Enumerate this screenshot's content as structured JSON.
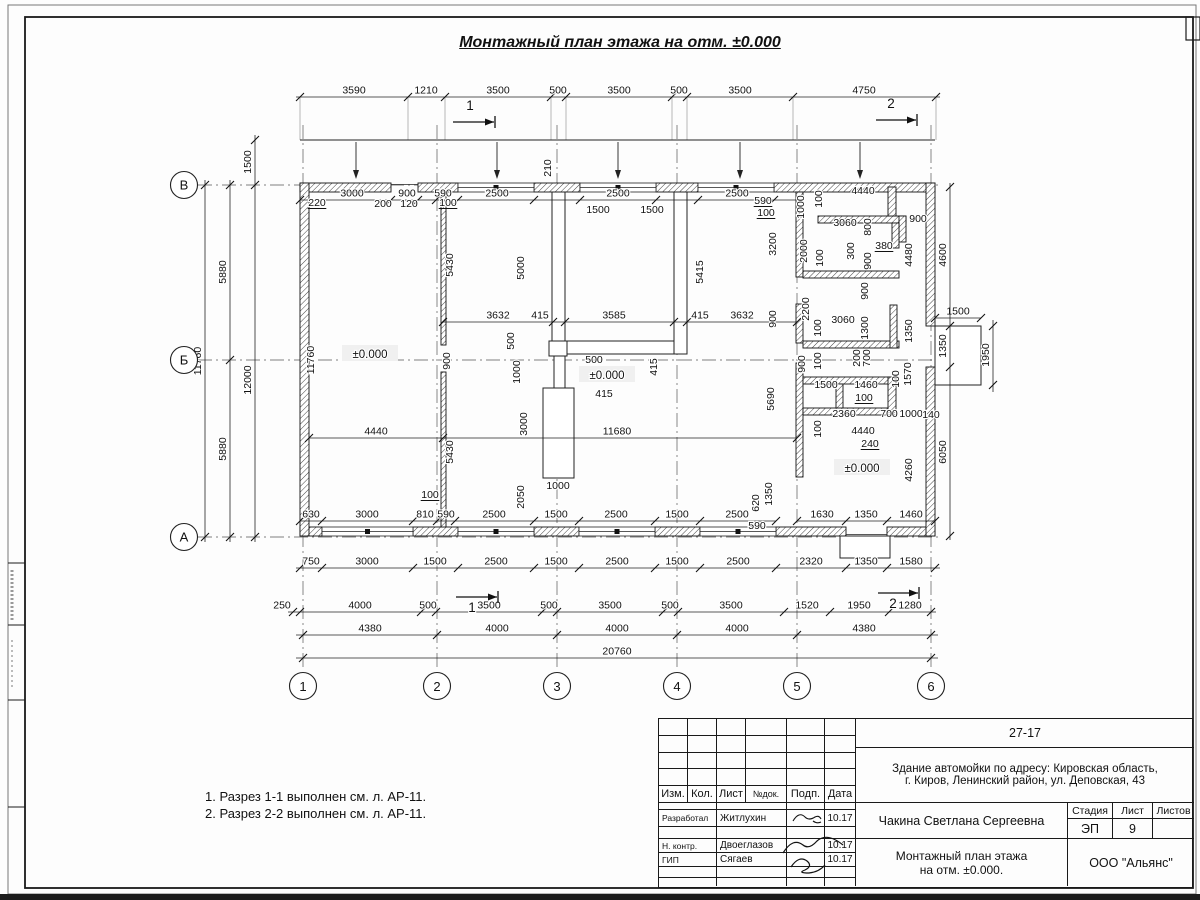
{
  "sheet_title": "Монтажный план этажа на отм. ±0.000",
  "notes": [
    "1. Разрез 1-1 выполнен см. л. АР-11.",
    "2. Разрез 2-2 выполнен см. л. АР-11."
  ],
  "title_block": {
    "doc_number": "27-17",
    "address_line1": "Здание автомойки по адресу: Кировская область,",
    "address_line2": "г. Киров, Ленинский район, ул. Деповская, 43",
    "header": {
      "izm": "Изм.",
      "kol": "Кол.",
      "list": "Лист",
      "ndok": "№док.",
      "podp": "Подп.",
      "data": "Дата"
    },
    "rows": [
      {
        "role": "Разработал",
        "name": "Житлухин",
        "date": "10.17"
      },
      {
        "role": "Н. контр.",
        "name": "Двоеглазов",
        "date": "10.17"
      },
      {
        "role": "ГИП",
        "name": "Сягаев",
        "date": "10.17"
      }
    ],
    "supervisor": "Чакина Светлана Сергеевна",
    "stage_label": "Стадия",
    "sheet_label": "Лист",
    "sheets_label": "Листов",
    "stage": "ЭП",
    "sheet_no": "9",
    "sheets_total": "",
    "drawing_name1": "Монтажный план этажа",
    "drawing_name2": "на отм. ±0.000.",
    "company": "ООО \"Альянс\""
  },
  "plan": {
    "axis_cols": [
      {
        "label": "1",
        "x": 303
      },
      {
        "label": "2",
        "x": 437
      },
      {
        "label": "3",
        "x": 557
      },
      {
        "label": "4",
        "x": 677
      },
      {
        "label": "5",
        "x": 797
      },
      {
        "label": "6",
        "x": 931
      }
    ],
    "axis_rows": [
      {
        "label": "В",
        "y": 185
      },
      {
        "label": "Б",
        "y": 360
      },
      {
        "label": "А",
        "y": 537
      }
    ],
    "levels": [
      {
        "t": "±0.000",
        "x": 370,
        "y": 355
      },
      {
        "t": "±0.000",
        "x": 607,
        "y": 376
      },
      {
        "t": "±0.000",
        "x": 862,
        "y": 469
      }
    ],
    "section_marks": [
      {
        "t": "1",
        "x": 470,
        "y": 110,
        "lx1": 453,
        "lx2": 494,
        "ly": 122
      },
      {
        "t": "2",
        "x": 891,
        "y": 108,
        "lx1": 876,
        "lx2": 916,
        "ly": 120
      },
      {
        "t": "1",
        "x": 472,
        "y": 612,
        "lx1": 456,
        "lx2": 497,
        "ly": 597
      },
      {
        "t": "2",
        "x": 893,
        "y": 608,
        "lx1": 878,
        "lx2": 918,
        "ly": 593
      }
    ],
    "dim_rows": [
      {
        "y": 97,
        "x1": 296,
        "x2": 940,
        "ext_to": 140,
        "ticks": [
          300,
          408,
          445,
          551,
          566,
          672,
          687,
          793,
          936
        ],
        "labels": [
          {
            "t": "3590",
            "x": 354
          },
          {
            "t": "1210",
            "x": 426
          },
          {
            "t": "3500",
            "x": 498
          },
          {
            "t": "500",
            "x": 558
          },
          {
            "t": "3500",
            "x": 619
          },
          {
            "t": "500",
            "x": 679
          },
          {
            "t": "3500",
            "x": 740
          },
          {
            "t": "4750",
            "x": 864
          }
        ]
      },
      {
        "y": 200,
        "x1": 300,
        "x2": 797,
        "ticks": [
          300,
          391,
          418,
          436,
          458,
          534,
          580,
          656,
          698,
          774
        ],
        "labels": [
          {
            "t": "3000",
            "x": 352
          },
          {
            "t": "900",
            "x": 407
          },
          {
            "t": "590",
            "x": 443
          },
          {
            "t": "2500",
            "x": 497
          },
          {
            "t": "2500",
            "x": 618
          },
          {
            "t": "2500",
            "x": 737
          }
        ]
      },
      {
        "y": 322,
        "x1": 443,
        "x2": 797,
        "ticks": [
          443,
          553,
          565,
          674,
          687,
          797
        ],
        "labels": [
          {
            "t": "3632",
            "x": 498
          },
          {
            "t": "415",
            "x": 540
          },
          {
            "t": "3585",
            "x": 614
          },
          {
            "t": "415",
            "x": 700
          },
          {
            "t": "3632",
            "x": 742
          }
        ]
      },
      {
        "y": 438,
        "x1": 309,
        "x2": 797,
        "ticks": [
          309,
          443,
          797
        ],
        "labels": [
          {
            "t": "4440",
            "x": 376
          },
          {
            "t": "11680",
            "x": 617
          }
        ]
      },
      {
        "y": 521,
        "x1": 300,
        "x2": 776,
        "ticks": [
          300,
          322,
          413,
          437,
          455,
          534,
          579,
          655,
          700,
          776
        ],
        "labels": [
          {
            "t": "630",
            "x": 311
          },
          {
            "t": "3000",
            "x": 367
          },
          {
            "t": "810",
            "x": 425
          },
          {
            "t": "590",
            "x": 446
          },
          {
            "t": "2500",
            "x": 494
          },
          {
            "t": "1500",
            "x": 556
          },
          {
            "t": "2500",
            "x": 616
          },
          {
            "t": "1500",
            "x": 677
          },
          {
            "t": "2500",
            "x": 737
          }
        ]
      },
      {
        "y": 521,
        "x1": 797,
        "x2": 935,
        "ticks": [
          797,
          846,
          887,
          935
        ],
        "labels": [
          {
            "t": "1630",
            "x": 822
          },
          {
            "t": "1350",
            "x": 866
          },
          {
            "t": "1460",
            "x": 911
          }
        ]
      },
      {
        "y": 568,
        "x1": 296,
        "x2": 940,
        "ticks": [
          300,
          322,
          413,
          458,
          534,
          579,
          655,
          700,
          776,
          846,
          887,
          935
        ],
        "labels": [
          {
            "t": "750",
            "x": 311
          },
          {
            "t": "3000",
            "x": 367
          },
          {
            "t": "1500",
            "x": 435
          },
          {
            "t": "2500",
            "x": 496
          },
          {
            "t": "1500",
            "x": 556
          },
          {
            "t": "2500",
            "x": 617
          },
          {
            "t": "1500",
            "x": 677
          },
          {
            "t": "2500",
            "x": 738
          },
          {
            "t": "2320",
            "x": 811
          },
          {
            "t": "1350",
            "x": 866
          },
          {
            "t": "1580",
            "x": 911
          }
        ]
      },
      {
        "y": 612,
        "x1": 288,
        "x2": 936,
        "ticks": [
          293,
          300,
          421,
          436,
          542,
          557,
          663,
          678,
          784,
          830,
          889,
          931
        ],
        "labels": [
          {
            "t": "250",
            "x": 282
          },
          {
            "t": "4000",
            "x": 360
          },
          {
            "t": "500",
            "x": 428
          },
          {
            "t": "3500",
            "x": 489
          },
          {
            "t": "500",
            "x": 549
          },
          {
            "t": "3500",
            "x": 610
          },
          {
            "t": "500",
            "x": 670
          },
          {
            "t": "3500",
            "x": 731
          },
          {
            "t": "1520",
            "x": 807
          },
          {
            "t": "1950",
            "x": 859
          },
          {
            "t": "1280",
            "x": 910
          }
        ]
      },
      {
        "y": 635,
        "x1": 296,
        "x2": 938,
        "ticks": [
          303,
          437,
          557,
          677,
          797,
          931
        ],
        "labels": [
          {
            "t": "4380",
            "x": 370
          },
          {
            "t": "4000",
            "x": 497
          },
          {
            "t": "4000",
            "x": 617
          },
          {
            "t": "4000",
            "x": 737
          },
          {
            "t": "4380",
            "x": 864
          }
        ]
      },
      {
        "y": 658,
        "x1": 296,
        "x2": 938,
        "ticks": [
          303,
          931
        ],
        "labels": [
          {
            "t": "20760",
            "x": 617
          }
        ]
      },
      {
        "y": 318,
        "x1": 935,
        "x2": 981,
        "ticks": [
          935,
          981
        ],
        "labels": [
          {
            "t": "1500",
            "x": 958
          }
        ]
      }
    ],
    "dim_cols": [
      {
        "x": 205,
        "y1": 180,
        "y2": 542,
        "ticks": [
          185,
          537
        ],
        "labels": [
          {
            "t": "11760",
            "y": 361
          }
        ]
      },
      {
        "x": 230,
        "y1": 180,
        "y2": 542,
        "ticks": [
          185,
          360,
          537
        ],
        "labels": [
          {
            "t": "5880",
            "y": 272
          },
          {
            "t": "5880",
            "y": 449
          }
        ]
      },
      {
        "x": 255,
        "y1": 135,
        "y2": 542,
        "ticks": [
          140,
          185,
          537
        ],
        "labels": [
          {
            "t": "1500",
            "y": 162
          },
          {
            "t": "12000",
            "y": 380
          }
        ]
      },
      {
        "x": 950,
        "y1": 183,
        "y2": 540,
        "ticks": [
          187,
          326,
          367,
          536
        ],
        "labels": [
          {
            "t": "4600",
            "y": 255
          },
          {
            "t": "1350",
            "y": 346
          },
          {
            "t": "6050",
            "y": 452
          }
        ]
      },
      {
        "x": 993,
        "y1": 320,
        "y2": 392,
        "ticks": [
          326,
          385
        ],
        "labels": [
          {
            "t": "1950",
            "y": 355
          }
        ]
      }
    ],
    "free_labels": [
      {
        "t": "220",
        "x": 317,
        "y": 206,
        "u": 1
      },
      {
        "t": "200",
        "x": 383,
        "y": 207
      },
      {
        "t": "120",
        "x": 409,
        "y": 207
      },
      {
        "t": "100",
        "x": 448,
        "y": 206,
        "u": 1
      },
      {
        "t": "1500",
        "x": 598,
        "y": 213
      },
      {
        "t": "1500",
        "x": 652,
        "y": 213
      },
      {
        "t": "590",
        "x": 763,
        "y": 204,
        "u": 1
      },
      {
        "t": "100",
        "x": 766,
        "y": 216,
        "u": 1
      },
      {
        "t": "210",
        "x": 551,
        "y": 168,
        "r": 1
      },
      {
        "t": "5430",
        "x": 453,
        "y": 265,
        "r": 1
      },
      {
        "t": "900",
        "x": 450,
        "y": 361,
        "r": 1
      },
      {
        "t": "5430",
        "x": 453,
        "y": 452,
        "r": 1
      },
      {
        "t": "5000",
        "x": 524,
        "y": 268,
        "r": 1
      },
      {
        "t": "500",
        "x": 514,
        "y": 341,
        "r": 1
      },
      {
        "t": "1000",
        "x": 520,
        "y": 372,
        "r": 1
      },
      {
        "t": "3000",
        "x": 527,
        "y": 424,
        "r": 1
      },
      {
        "t": "2050",
        "x": 524,
        "y": 497,
        "r": 1
      },
      {
        "t": "500",
        "x": 594,
        "y": 363
      },
      {
        "t": "415",
        "x": 604,
        "y": 397
      },
      {
        "t": "1000",
        "x": 558,
        "y": 489
      },
      {
        "t": "415",
        "x": 657,
        "y": 367,
        "r": 1
      },
      {
        "t": "5415",
        "x": 703,
        "y": 272,
        "r": 1
      },
      {
        "t": "5690",
        "x": 774,
        "y": 399,
        "r": 1
      },
      {
        "t": "620",
        "x": 759,
        "y": 503,
        "r": 1
      },
      {
        "t": "1350",
        "x": 772,
        "y": 494,
        "r": 1
      },
      {
        "t": "590",
        "x": 757,
        "y": 529
      },
      {
        "t": "11760",
        "x": 314,
        "y": 360,
        "r": 1
      },
      {
        "t": "100",
        "x": 430,
        "y": 498,
        "u": 1
      },
      {
        "t": "1000",
        "x": 804,
        "y": 207,
        "r": 1
      },
      {
        "t": "100",
        "x": 822,
        "y": 199,
        "r": 1
      },
      {
        "t": "4440",
        "x": 863,
        "y": 194
      },
      {
        "t": "3060",
        "x": 845,
        "y": 226
      },
      {
        "t": "800",
        "x": 871,
        "y": 227,
        "r": 1
      },
      {
        "t": "900",
        "x": 918,
        "y": 222
      },
      {
        "t": "380",
        "x": 884,
        "y": 249,
        "u": 1
      },
      {
        "t": "4480",
        "x": 912,
        "y": 255,
        "r": 1
      },
      {
        "t": "2000",
        "x": 807,
        "y": 251,
        "r": 1
      },
      {
        "t": "100",
        "x": 823,
        "y": 258,
        "r": 1
      },
      {
        "t": "300",
        "x": 854,
        "y": 251,
        "r": 1
      },
      {
        "t": "900",
        "x": 871,
        "y": 261,
        "r": 1
      },
      {
        "t": "3200",
        "x": 776,
        "y": 244,
        "r": 1
      },
      {
        "t": "900",
        "x": 776,
        "y": 319,
        "r": 1
      },
      {
        "t": "2200",
        "x": 809,
        "y": 309,
        "r": 1
      },
      {
        "t": "900",
        "x": 868,
        "y": 291,
        "r": 1
      },
      {
        "t": "3060",
        "x": 843,
        "y": 323
      },
      {
        "t": "100",
        "x": 821,
        "y": 328,
        "r": 1
      },
      {
        "t": "1300",
        "x": 868,
        "y": 328,
        "r": 1
      },
      {
        "t": "1350",
        "x": 912,
        "y": 331,
        "r": 1
      },
      {
        "t": "900",
        "x": 805,
        "y": 364,
        "r": 1
      },
      {
        "t": "100",
        "x": 821,
        "y": 361,
        "r": 1
      },
      {
        "t": "200",
        "x": 860,
        "y": 358,
        "r": 1
      },
      {
        "t": "700",
        "x": 870,
        "y": 358,
        "r": 1
      },
      {
        "t": "1500",
        "x": 826,
        "y": 388
      },
      {
        "t": "1460",
        "x": 866,
        "y": 388
      },
      {
        "t": "100",
        "x": 899,
        "y": 379,
        "r": 1
      },
      {
        "t": "1570",
        "x": 911,
        "y": 374,
        "r": 1
      },
      {
        "t": "100",
        "x": 864,
        "y": 401,
        "u": 1
      },
      {
        "t": "2360",
        "x": 844,
        "y": 417
      },
      {
        "t": "700",
        "x": 889,
        "y": 417
      },
      {
        "t": "1000",
        "x": 911,
        "y": 417
      },
      {
        "t": "140",
        "x": 931,
        "y": 418
      },
      {
        "t": "100",
        "x": 821,
        "y": 429,
        "r": 1
      },
      {
        "t": "4440",
        "x": 863,
        "y": 434
      },
      {
        "t": "240",
        "x": 870,
        "y": 447,
        "u": 1
      },
      {
        "t": "4260",
        "x": 912,
        "y": 470,
        "r": 1
      }
    ]
  }
}
